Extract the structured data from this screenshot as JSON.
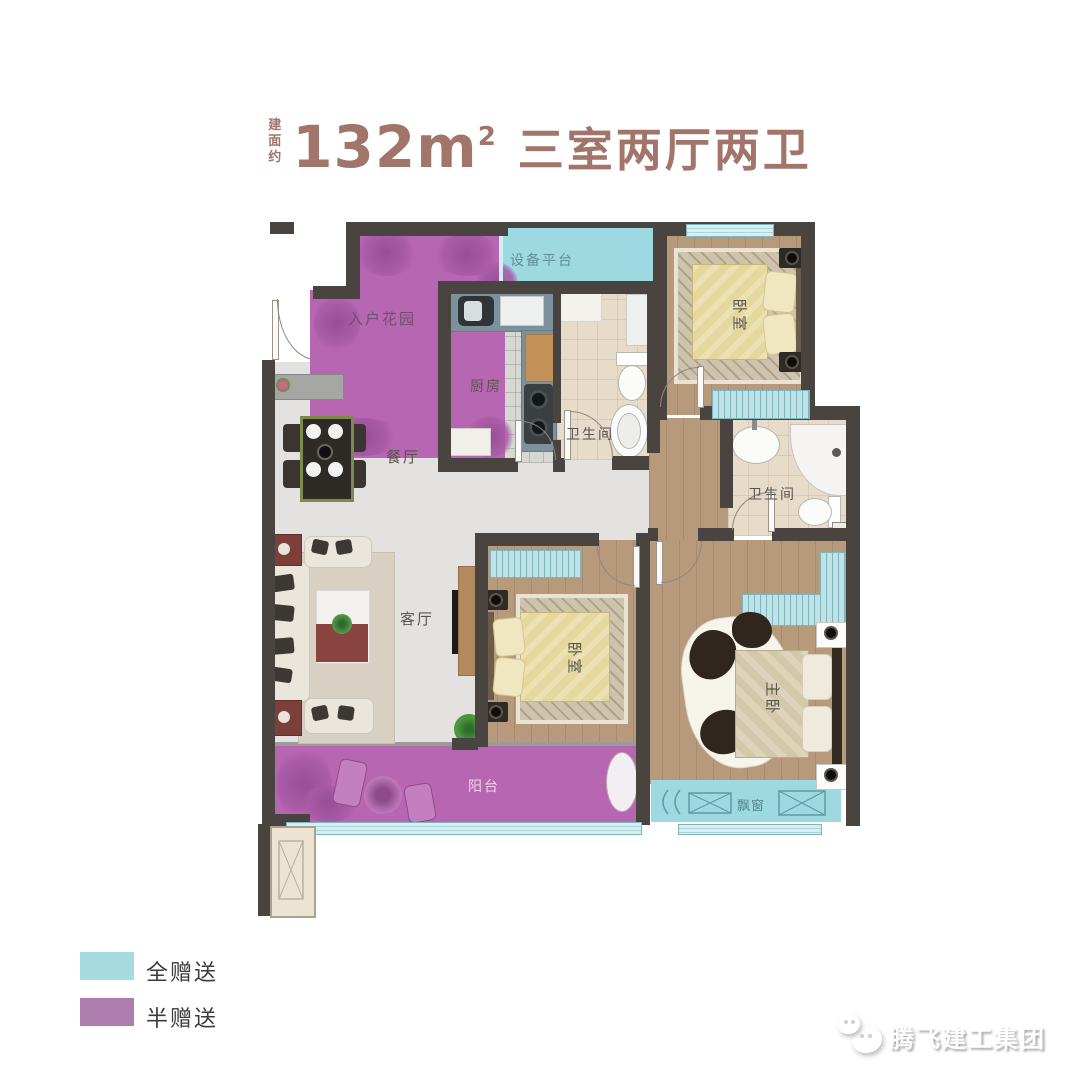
{
  "title": {
    "prefix": "建面约",
    "area_value": "132",
    "area_unit": "m",
    "area_exponent": "2",
    "suffix": "三室两厅两卫"
  },
  "rooms": {
    "entry_garden": "入户花园",
    "equipment_platform": "设备平台",
    "kitchen": "厨房",
    "bathroom_1": "卫生间",
    "bathroom_2": "卫生间",
    "bedroom_1": "卧室",
    "bedroom_2": "卧室",
    "master_bedroom": "主卧",
    "dining_room": "餐厅",
    "living_room": "客厅",
    "balcony": "阳台",
    "bay_window": "飘窗"
  },
  "legend": [
    {
      "label": "全赠送",
      "color": "#a6dbe2"
    },
    {
      "label": "半赠送",
      "color": "#ad7ead"
    }
  ],
  "watermark": {
    "text": "腾飞建工集团"
  },
  "colors": {
    "title_brown": "#a1756a",
    "wall": "#4a4440",
    "full_gift_cyan": "#9ed8e0",
    "half_gift_purple": "#b766b2"
  }
}
